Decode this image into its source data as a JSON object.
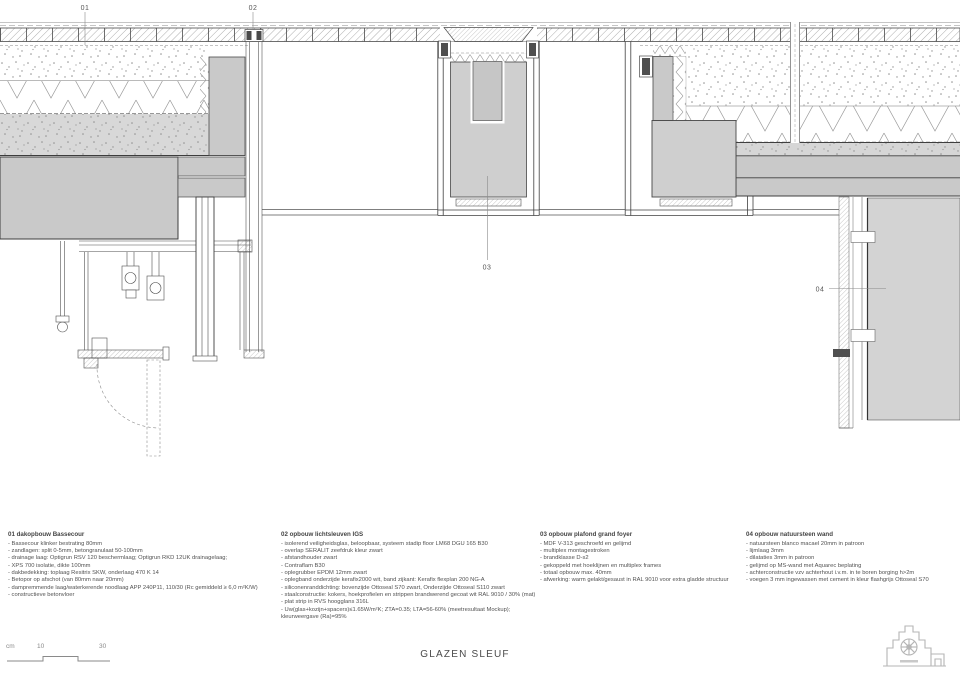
{
  "sheet": {
    "title": "GLAZEN SLEUF",
    "scale_bar": {
      "unit": "cm",
      "tick_10": "10",
      "tick_30": "30"
    }
  },
  "callouts": {
    "c01": "01",
    "c02": "02",
    "c03": "03",
    "c04": "04"
  },
  "notes": {
    "block01": {
      "heading": "01 dakopbouw Bassecour",
      "lines": [
        "- Bassecour klinker bestrating 80mm",
        "- zandlagen: split 0-5mm, betongranulaat 50-100mm",
        "- drainage laag: Optigrun RSV 120 beschermlaag; Optigrun RKD 12UK drainagelaag;",
        "- XPS 700 isolatie, dikte 100mm",
        "- dakbedekking: toplaag Resitrix SKW, onderlaag 470 K 14",
        "- Betopor op afschot (van 80mm naar 20mm)",
        "- dampremmende laag/waterkerende noodlaag APP 240P11, 110/30 (Rc gemiddeld ≥ 6,0 m²K/W)",
        "- constructieve betonvloer"
      ]
    },
    "block02": {
      "heading": "02 opbouw lichtsleuven IGS",
      "lines": [
        "- isolerend veiligheidsglas, beloopbaar, systeem stadip floor LM68 DGU 165 B30",
        "- overlap SERALIT zeefdruk kleur zwart",
        "- afstandhouder zwart",
        "- Contraflam B30",
        "- oplegrubber EPDM 12mm zwart",
        "- oplegband onderzijde kerafix2000 wit, band zijkant: Kerafix flexplan 200 NG-A",
        "- siliconenranddichting: bovenzijde Ottoseal S70 zwart, Onderzijde Ottoseal S110 zwart",
        "- staalconstructie: kokers, hoekprofielen en strippen brandwerend gecoat wit RAL 9010 / 30% (mat)",
        "- plat strip in RVS hoogglans 316L",
        "- Uw(glas+kozijn+spacers)≤1.65W/m²K; ZTA=0.35; LTA=56-60% (meetresultaat Mockup);",
        "kleurweergave (Ra)=95%"
      ]
    },
    "block03": {
      "heading": "03 opbouw plafond grand foyer",
      "lines": [
        "- MDF V-313 geschroefd en gelijmd",
        "- multiplex montagestroken",
        "- brandklasse D-s2",
        "- gekoppeld met hoeklijnen en multiplex frames",
        "- totaal opbouw max. 40mm",
        "- afwerking: warm gelakt/gesaust in RAL 9010 voor extra gladde structuur"
      ]
    },
    "block04": {
      "heading": "04 opbouw natuursteen wand",
      "lines": [
        "- natuursteen blanco macael 20mm in patroon",
        "- lijmlaag 3mm",
        "- dilataties 3mm in patroon",
        "- gelijmd op MS-wand met Aquarec beplating",
        "- achterconstructie vzv achterhout i.v.m. in te boren borging h>2m",
        "- voegen 3 mm ingewassen met cement in kleur flashgrijs Ottoseal S70"
      ]
    }
  },
  "colors": {
    "paper": "#ffffff",
    "line_dark": "#3f3f3f",
    "line_light": "#9a9a9a",
    "fill_concrete": "#c9c9c9",
    "fill_block": "#cfcfcf",
    "fill_panel": "#d3d3d3",
    "text": "#4b4b4b"
  }
}
